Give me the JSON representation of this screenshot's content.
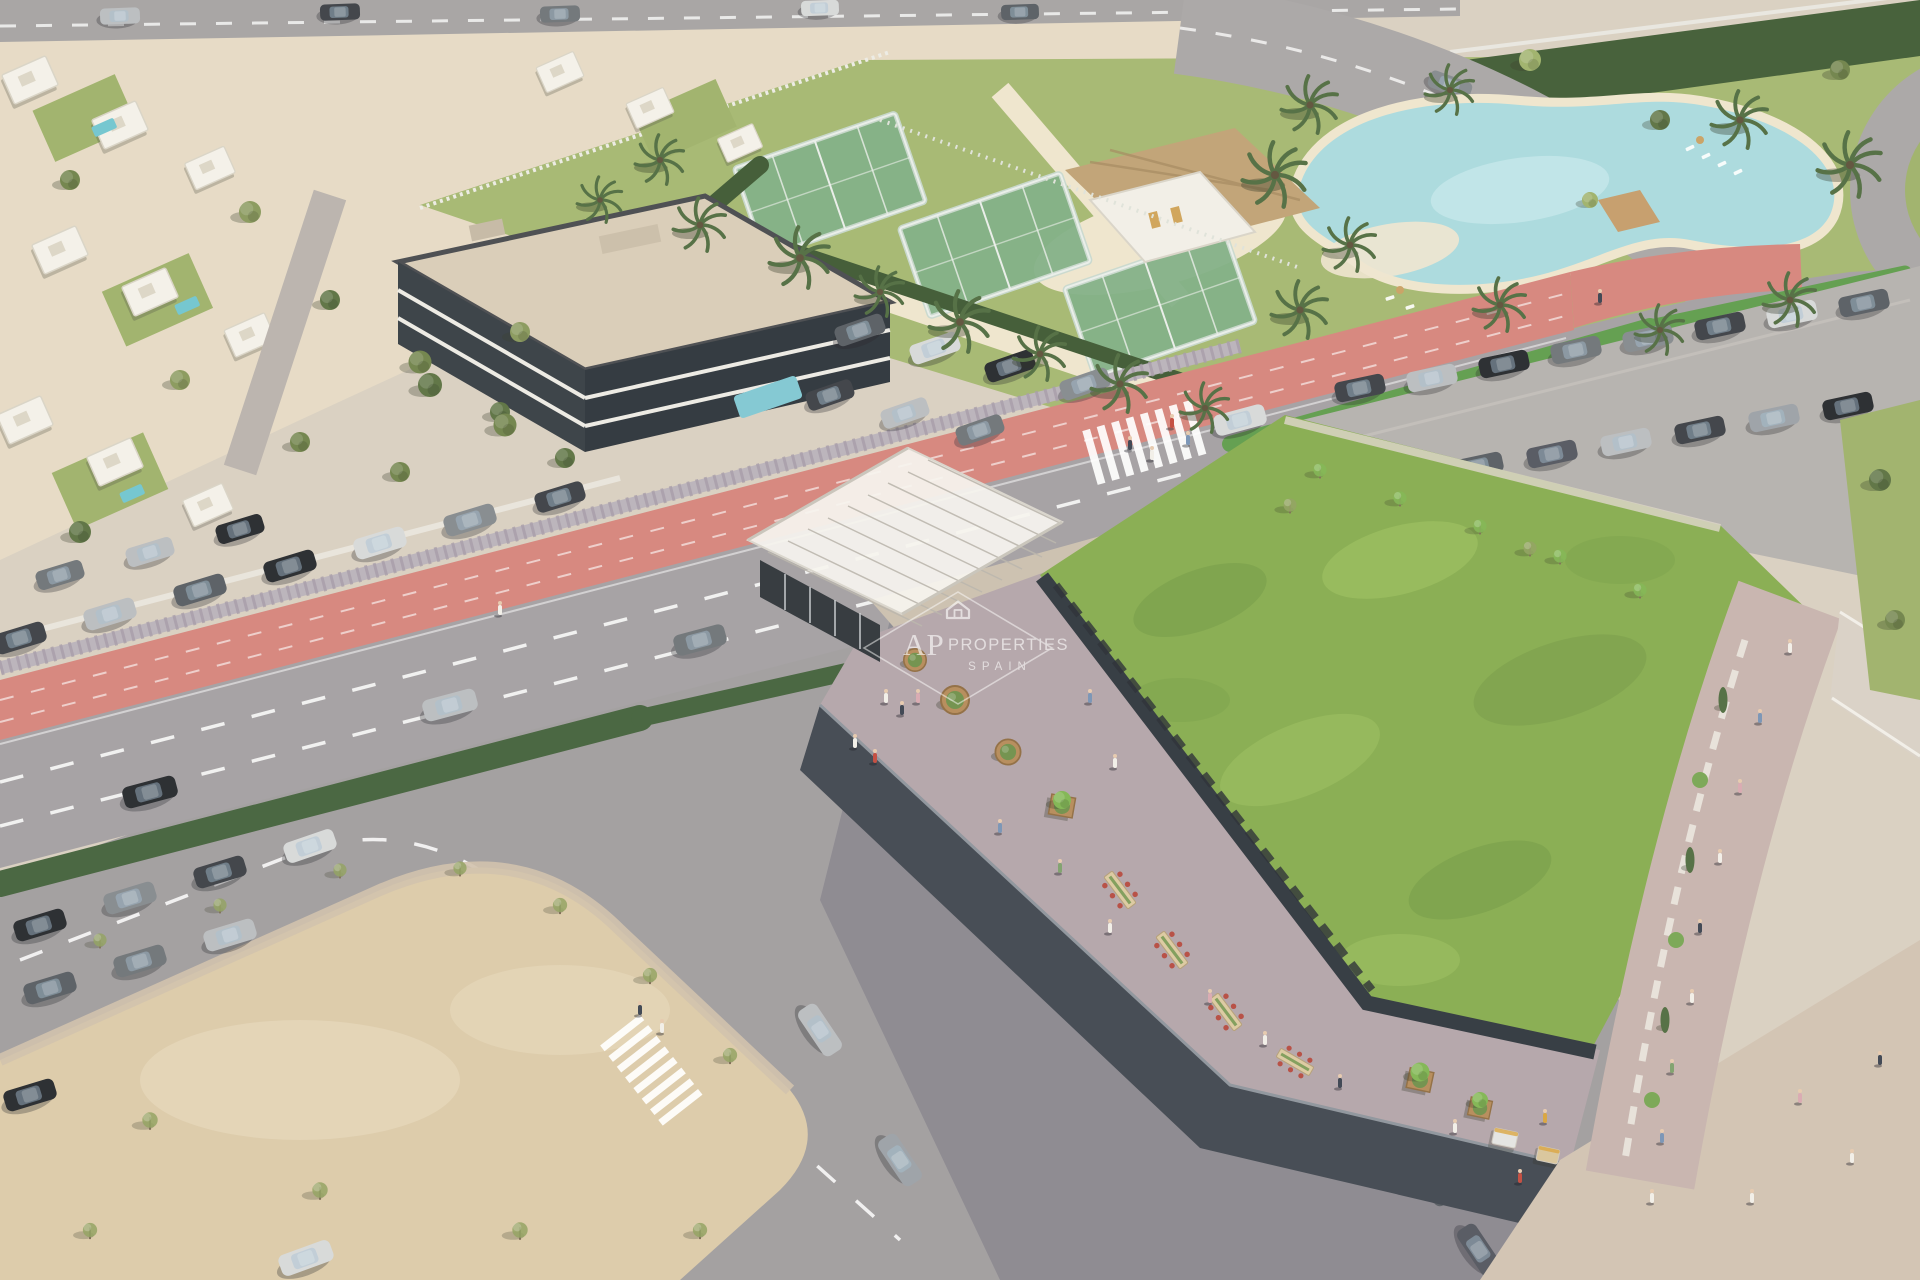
{
  "scene": {
    "title": "aerial-development-render",
    "watermark": {
      "initials": "AP",
      "name": "PROPERTIES",
      "region": "SPAIN"
    },
    "colors": {
      "avenue": "#a39fa2",
      "bike_lane": "#d5837b",
      "green_roof": "#85ab4d",
      "club_lawn": "#a4b76f",
      "sand_lot": "#dccaa8",
      "lagoon": "#a9dade",
      "apartment_roof": "#d9ccb7",
      "plaza": "#d1c2b2",
      "terrace": "#b3a4a9",
      "facade": "#3f454e",
      "residential_ground": "#e6dac4",
      "asphalt": "#a09c9e",
      "watermark": "#ffffff"
    }
  }
}
